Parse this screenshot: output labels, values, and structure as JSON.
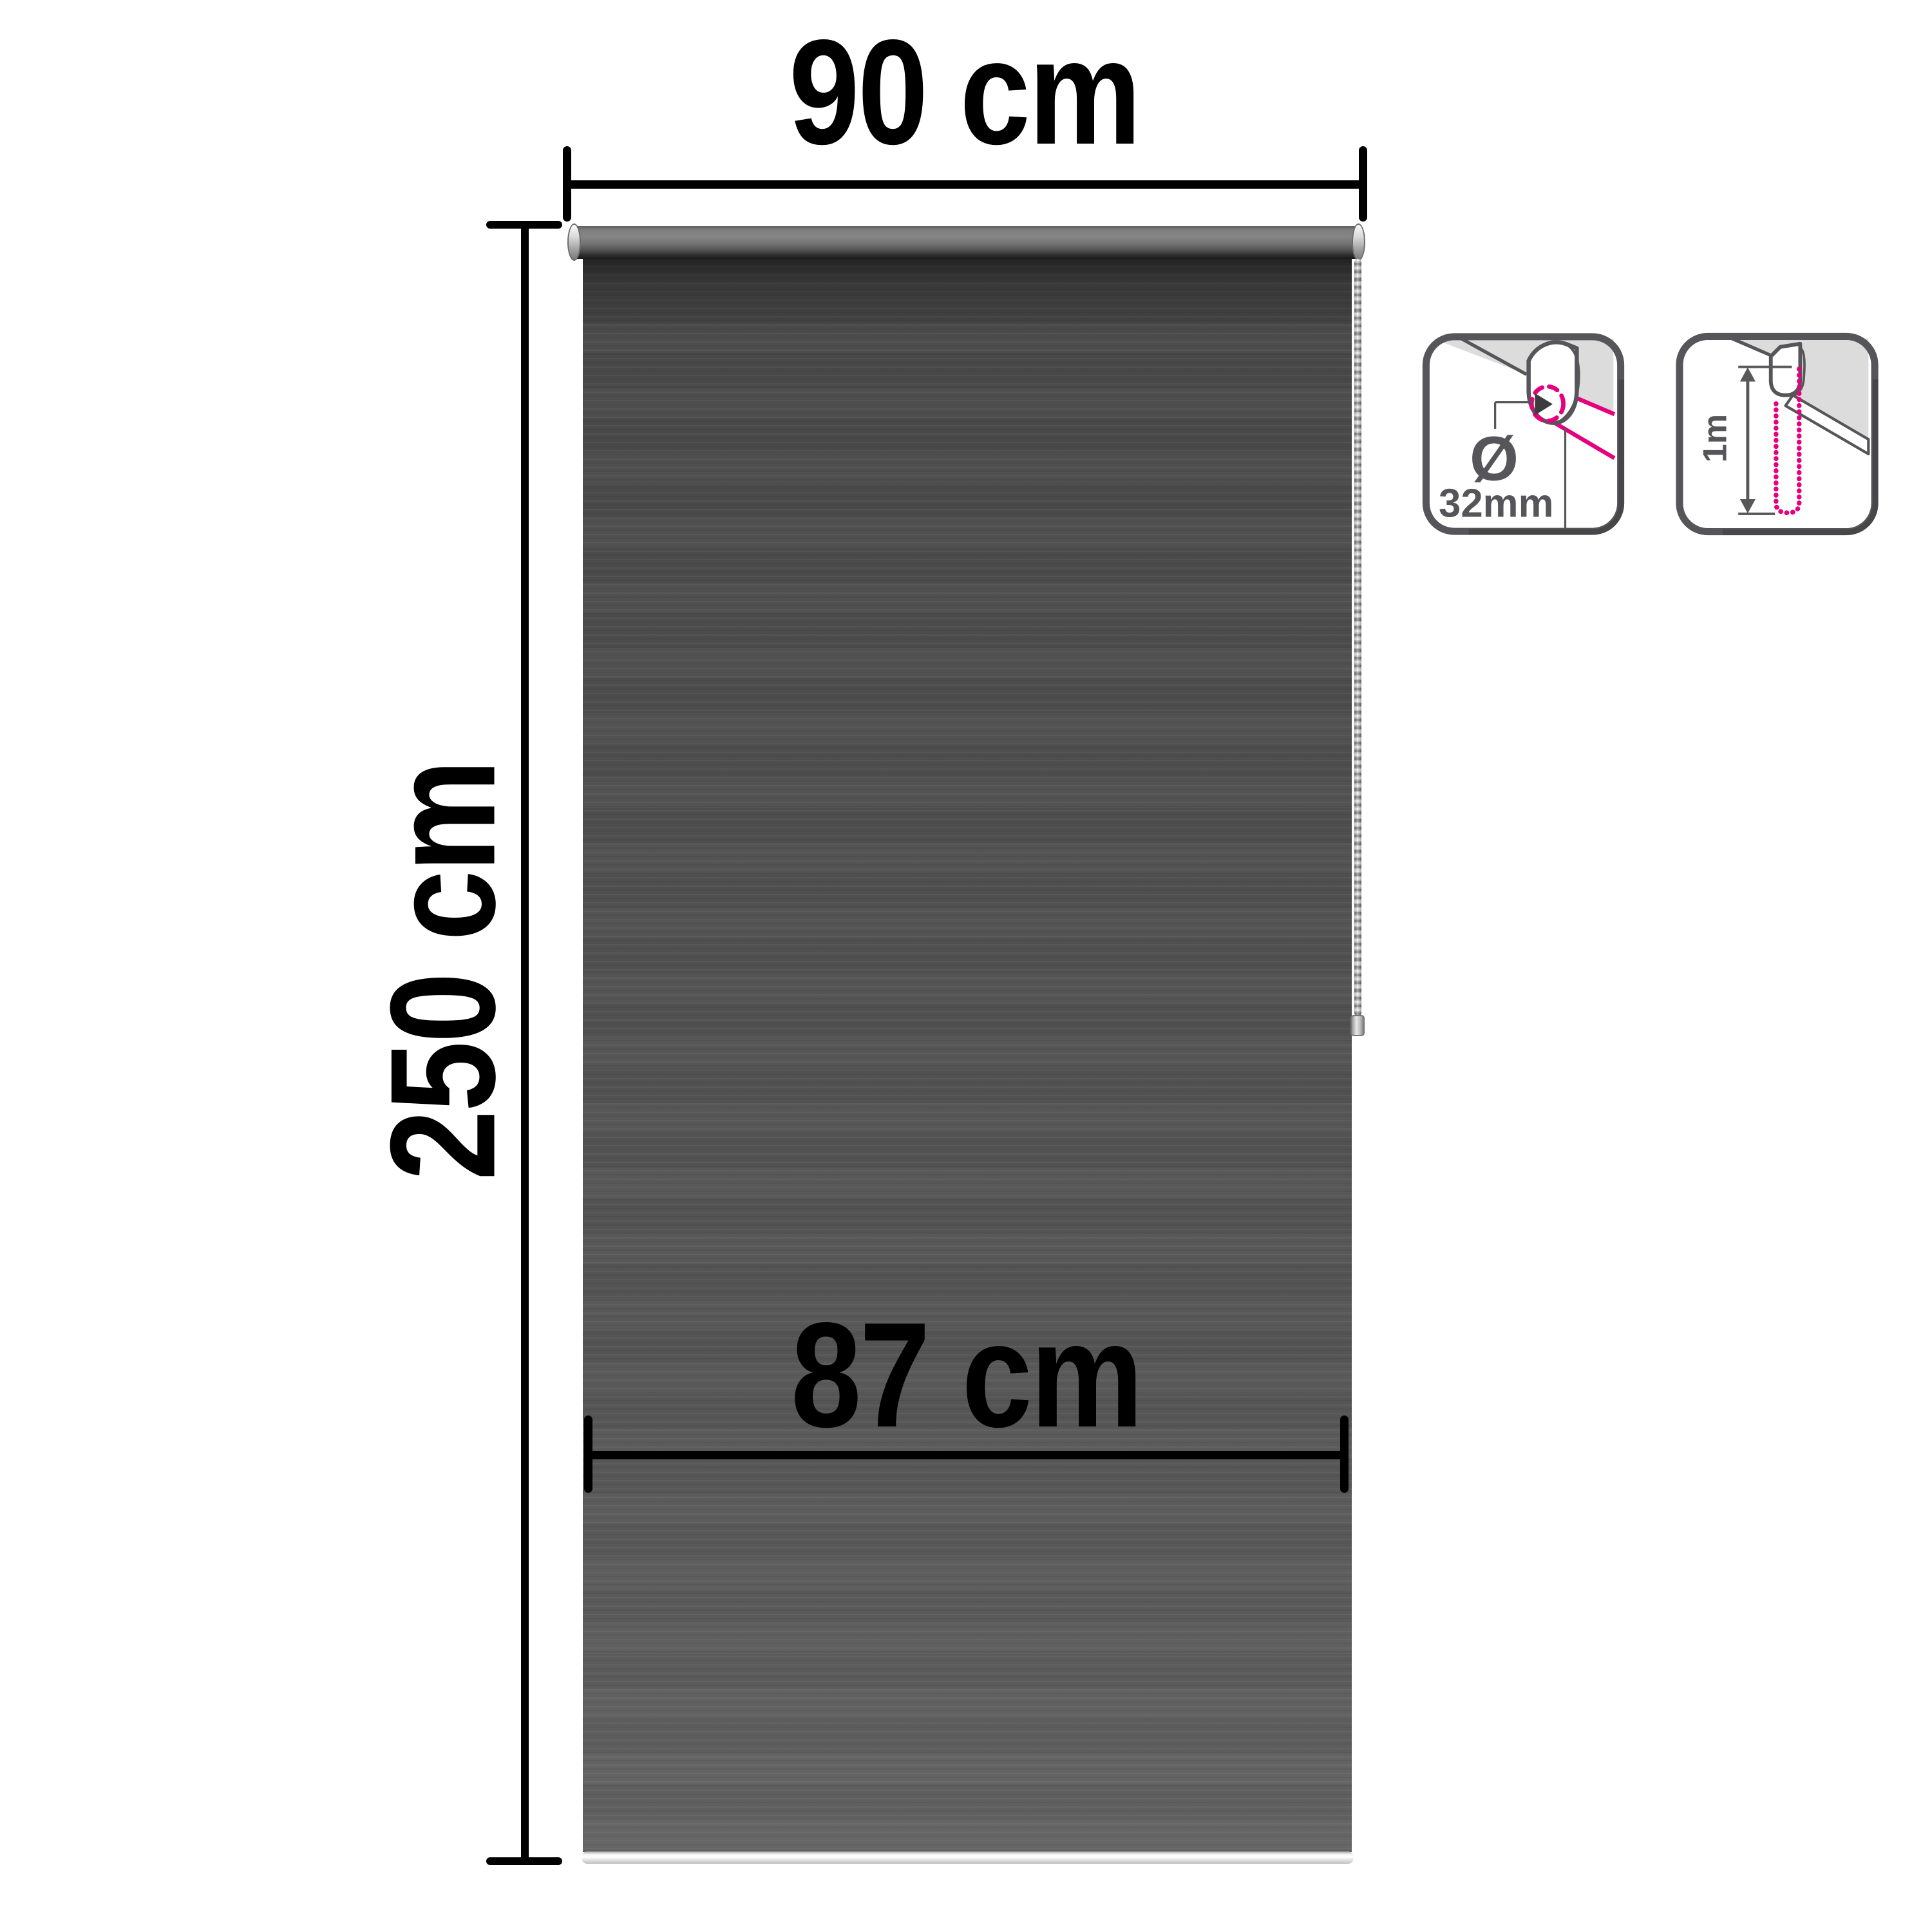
{
  "diagram": {
    "title": "roller blind dimension diagram",
    "width_dimension": {
      "label": "90 cm"
    },
    "height_dimension": {
      "label": "250 cm"
    },
    "fabric_width_dimension": {
      "label": "87 cm"
    }
  },
  "info_icons": {
    "tube_diameter": {
      "icon": "tube-diameter-icon",
      "symbol": "Ø",
      "value": "32mm"
    },
    "chain_drop_length": {
      "icon": "chain-drop-length-icon",
      "value": "1m"
    }
  },
  "colors": {
    "background": "#ffffff",
    "dimension_line": "#000000",
    "label_text": "#000000",
    "icon_outline_gray": "#56565a",
    "icon_surface_gray": "#dcdcdc",
    "accent_magenta": "#e6007e",
    "fabric_top": "#414141",
    "fabric_bottom": "#636363"
  }
}
